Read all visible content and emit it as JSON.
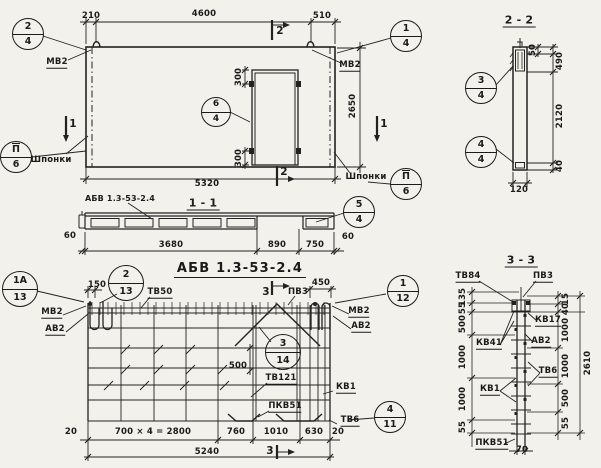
{
  "colors": {
    "paper": "#f2f1ec",
    "ink": "#1b1b1b"
  },
  "main_title": "АБВ 1.3-53-2.4",
  "plan": {
    "dim_210": "210",
    "dim_4600": "4600",
    "dim_510": "510",
    "dim_2650": "2650",
    "dim_5320": "5320",
    "dim_300_top": "300",
    "dim_300_bot": "300",
    "label_mv2_left": "МВ2",
    "label_mv2_right": "МВ2",
    "label_shponki_left": "Шпонки",
    "label_shponki_right": "Шпонки",
    "mark_1": "1",
    "mark_2": "2",
    "balloon_2_4": {
      "num": "2",
      "den": "4"
    },
    "balloon_1_4": {
      "num": "1",
      "den": "4"
    },
    "balloon_6_4": {
      "num": "6",
      "den": "4"
    },
    "balloon_p_6": {
      "num": "П",
      "den": "6"
    }
  },
  "section22": {
    "title": "2 - 2",
    "dim_50": "50",
    "dim_490": "490",
    "dim_2120": "2120",
    "dim_40": "40",
    "dim_120": "120",
    "balloon_3_4": {
      "num": "3",
      "den": "4"
    },
    "balloon_4_4": {
      "num": "4",
      "den": "4"
    }
  },
  "section11": {
    "title": "1 - 1",
    "beam_label": "АБВ 1.3-53-2.4",
    "dim_60_left": "60",
    "dim_3680": "3680",
    "dim_890": "890",
    "dim_750": "750",
    "dim_60_right": "60",
    "balloon_5_4": {
      "num": "5",
      "den": "4"
    }
  },
  "reinf": {
    "dim_150": "150",
    "dim_450": "450",
    "dim_500": "500",
    "dim_20_left": "20",
    "dim_700x4": "700 × 4 = 2800",
    "dim_760": "760",
    "dim_1010": "1010",
    "dim_630": "630",
    "dim_20_right": "20",
    "dim_5240": "5240",
    "mark_3": "3",
    "label_tv50": "ТВ50",
    "label_pv3": "ПВ3",
    "label_mv2_left": "МВ2",
    "label_av2_left": "АВ2",
    "label_mv2_right": "МВ2",
    "label_av2_right": "АВ2",
    "label_tv121": "ТВ121",
    "label_kv1": "КВ1",
    "label_pkv51": "ПКВ51",
    "label_tv6": "ТВ6",
    "balloon_1a_13": {
      "num": "1А",
      "den": "13"
    },
    "balloon_2_13": {
      "num": "2",
      "den": "13"
    },
    "balloon_1_12": {
      "num": "1",
      "den": "12"
    },
    "balloon_3_14": {
      "num": "3",
      "den": "14"
    },
    "balloon_4_11": {
      "num": "4",
      "den": "11"
    }
  },
  "section33": {
    "title": "3 - 3",
    "labels": {
      "tv84": "ТВ84",
      "pv3": "ПВ3",
      "kv17": "КВ17",
      "av2": "АВ2",
      "tv6": "ТВ6",
      "kv41": "КВ41",
      "kv1": "КВ1",
      "pkv51": "ПКВ51"
    },
    "dims_left": [
      "135",
      "55",
      "500",
      "1000",
      "1000",
      "55"
    ],
    "dims_right": [
      "15",
      "40",
      "1000",
      "1000",
      "500",
      "55"
    ],
    "dim_total": "2610",
    "dim_70": "70"
  }
}
